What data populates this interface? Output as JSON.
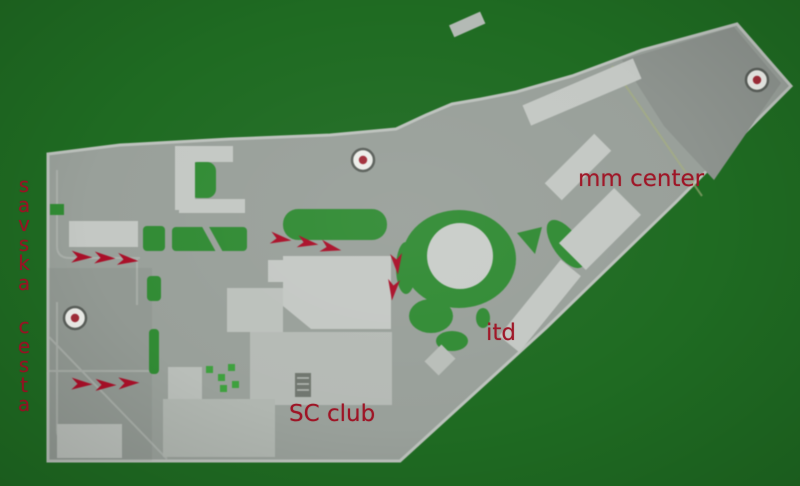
{
  "colors": {
    "background": "#1f6b22",
    "ground": "#99a09a",
    "building": "#c4c8c4",
    "lawn": "#2e8c31",
    "tree": "#3aa23a",
    "label_red": "#9e1425",
    "arrow_red": "#b00d28",
    "marker_ring": "#5a5f5a",
    "marker_fill": "#ecede9",
    "marker_glyph": "#a62c38"
  },
  "labels": {
    "street": {
      "text": "savska cesta",
      "orientation": "vertical"
    },
    "mm_center": {
      "text": "mm center"
    },
    "itd": {
      "text": "itd"
    },
    "sc_club": {
      "text": "SC club"
    }
  },
  "annotations": {
    "markers": [
      {
        "id": "marker-central",
        "x": 363,
        "y": 160
      },
      {
        "id": "marker-northeast",
        "x": 757,
        "y": 80
      },
      {
        "id": "marker-west",
        "x": 75,
        "y": 318
      }
    ],
    "arrow_groups": [
      {
        "id": "upper-west-route",
        "arrows": [
          {
            "x": 82,
            "y": 257,
            "angle": 2
          },
          {
            "x": 105,
            "y": 258,
            "angle": 3
          },
          {
            "x": 128,
            "y": 260,
            "angle": 6
          }
        ]
      },
      {
        "id": "central-route",
        "arrows": [
          {
            "x": 281,
            "y": 239,
            "angle": 8
          },
          {
            "x": 308,
            "y": 243,
            "angle": 9
          },
          {
            "x": 331,
            "y": 248,
            "angle": 13
          }
        ]
      },
      {
        "id": "turn-south-route",
        "arrows": [
          {
            "x": 397,
            "y": 264,
            "angle": 85
          },
          {
            "x": 393,
            "y": 290,
            "angle": 96
          }
        ]
      },
      {
        "id": "lower-west-route",
        "arrows": [
          {
            "x": 82,
            "y": 384,
            "angle": 2
          },
          {
            "x": 106,
            "y": 385,
            "angle": 1
          },
          {
            "x": 129,
            "y": 383,
            "angle": -2
          }
        ]
      }
    ]
  }
}
